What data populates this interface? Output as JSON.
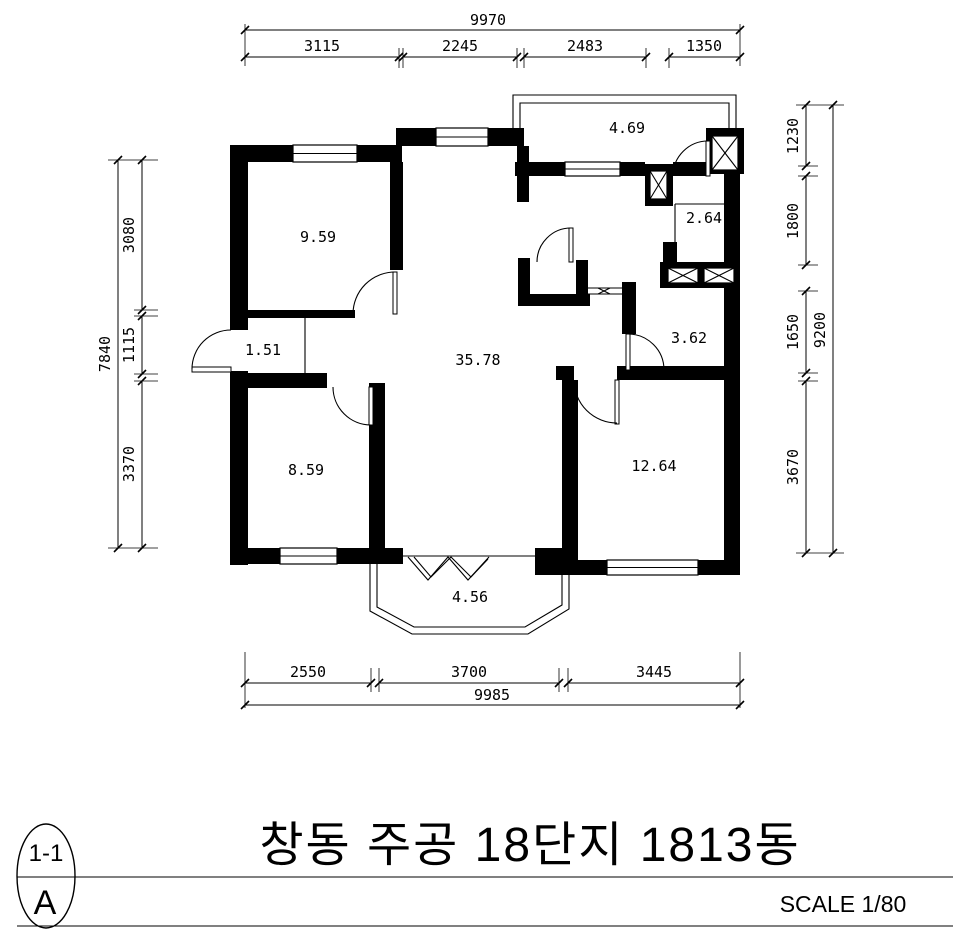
{
  "drawing": {
    "title": "창동 주공 18단지 1813동",
    "scale_label": "SCALE 1/80",
    "detail_marker": {
      "top": "1-1",
      "bottom": "A"
    },
    "room_areas": {
      "bedroom_top_left": "9.59",
      "balcony_top": "4.69",
      "bath_right": "2.64",
      "entry": "1.51",
      "living": "35.78",
      "bath_mid": "3.62",
      "bedroom_bottom_left": "8.59",
      "bedroom_bottom_right": "12.64",
      "balcony_bottom": "4.56"
    },
    "dimensions": {
      "top": {
        "total": "9970",
        "segments": [
          "3115",
          "2245",
          "2483",
          "1350"
        ]
      },
      "bottom": {
        "total": "9985",
        "segments": [
          "2550",
          "3700",
          "3445"
        ]
      },
      "left": {
        "total": "7840",
        "segments": [
          "3080",
          "1115",
          "3370"
        ]
      },
      "right": {
        "total": "9200",
        "segments": [
          "1230",
          "1800",
          "1650",
          "3670"
        ]
      }
    }
  }
}
